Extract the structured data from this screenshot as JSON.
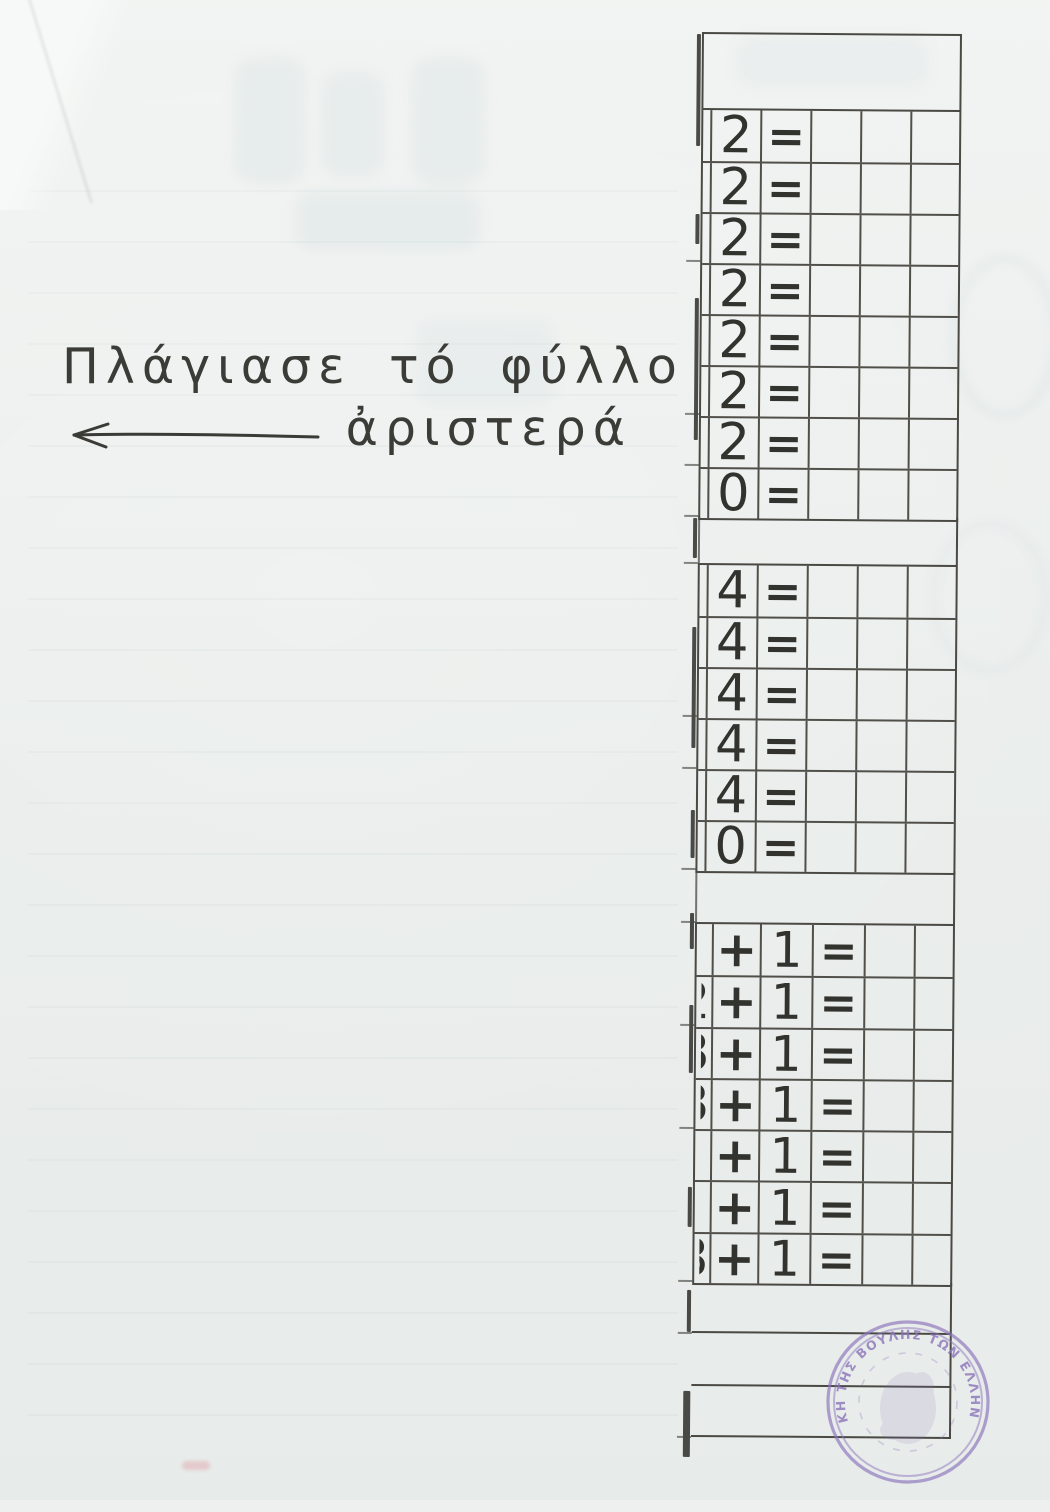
{
  "page": {
    "instruction_line1": "Πλάγιασε τό φύλλο",
    "instruction_line2": "ἀριστερά",
    "arrow_direction": "left"
  },
  "worksheet": {
    "sections": [
      {
        "name": "twos",
        "rows": [
          [
            "2",
            "="
          ],
          [
            "2",
            "="
          ],
          [
            "2",
            "="
          ],
          [
            "2",
            "="
          ],
          [
            "2",
            "="
          ],
          [
            "2",
            "="
          ],
          [
            "2",
            "="
          ],
          [
            "0",
            "="
          ]
        ]
      },
      {
        "name": "fours",
        "rows": [
          [
            "4",
            "="
          ],
          [
            "4",
            "="
          ],
          [
            "4",
            "="
          ],
          [
            "4",
            "="
          ],
          [
            "4",
            "="
          ],
          [
            "0",
            "="
          ]
        ]
      },
      {
        "name": "plus-one",
        "rows": [
          [
            "+",
            "1",
            "="
          ],
          [
            "+",
            "1",
            "="
          ],
          [
            "+",
            "1",
            "="
          ],
          [
            "+",
            "1",
            "="
          ],
          [
            "+",
            "1",
            "="
          ],
          [
            "+",
            "1",
            "="
          ],
          [
            "+",
            "1",
            "="
          ]
        ],
        "left_fragments": [
          "",
          "2",
          "3",
          "3",
          "",
          "",
          "8"
        ]
      }
    ]
  },
  "stamp": {
    "text": "ΚΗ ΤΗΣ ΒΟΥΛΗΣ ΤΩΝ ΕΛΛΗΝΩΝ",
    "color": "#8d76bc"
  },
  "colors": {
    "paper": "#edf0ee",
    "ink": "#32322e",
    "grid": "#4a4944",
    "stamp": "#8d76bc"
  }
}
